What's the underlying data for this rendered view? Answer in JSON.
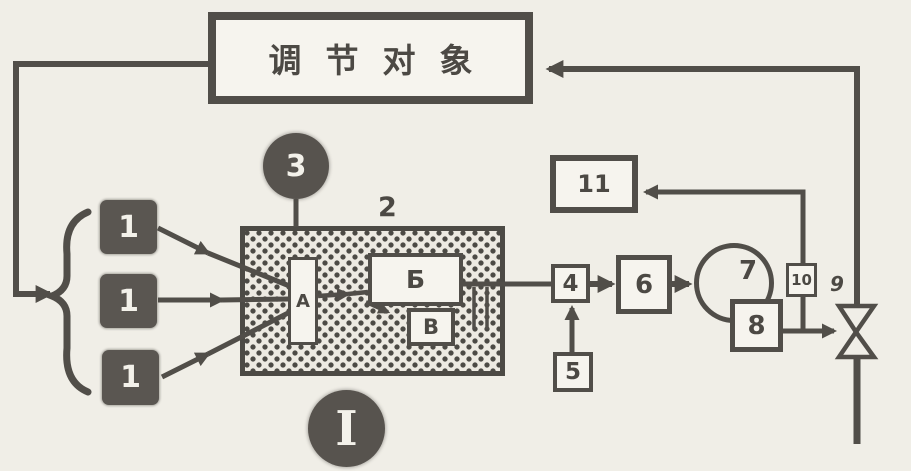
{
  "colors": {
    "ink": "#514e49",
    "paper": "#f0eee7",
    "node_fill": "#f6f4ee",
    "dark_fill": "#5a5651"
  },
  "title_box": {
    "label": "调节对象"
  },
  "nodes": {
    "n1a": {
      "label": "1"
    },
    "n1b": {
      "label": "1"
    },
    "n1c": {
      "label": "1"
    },
    "n2": {
      "label": "2"
    },
    "n3": {
      "label": "3"
    },
    "nA": {
      "label": "А"
    },
    "nB": {
      "label": "Б"
    },
    "nV": {
      "label": "В"
    },
    "n4": {
      "label": "4"
    },
    "n5": {
      "label": "5"
    },
    "n6": {
      "label": "6"
    },
    "n7": {
      "label": "7"
    },
    "n8": {
      "label": "8"
    },
    "n9": {
      "label": "9"
    },
    "n10": {
      "label": "10"
    },
    "n11": {
      "label": "11"
    }
  },
  "figure_label": "I"
}
